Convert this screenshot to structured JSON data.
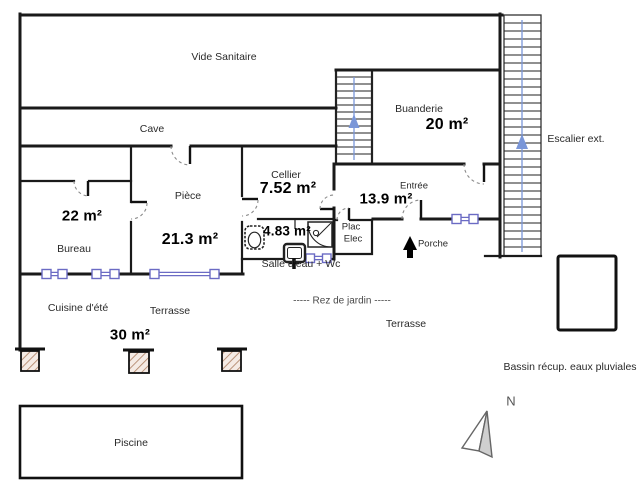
{
  "plan": {
    "rooms": {
      "vide_sanitaire": {
        "name": "Vide Sanitaire"
      },
      "cave": {
        "name": "Cave"
      },
      "buanderie": {
        "name": "Buanderie",
        "area": "20 m²"
      },
      "cellier": {
        "name": "Cellier",
        "area": "7.52 m²"
      },
      "piece": {
        "name": "Pièce",
        "area": "21.3 m²"
      },
      "bureau": {
        "name": "Bureau",
        "area": "22 m²"
      },
      "entree": {
        "name": "Entrée",
        "area": "13.9 m²"
      },
      "salle_eau": {
        "name": "Salle d'eau + Wc",
        "area": "4.83 m²"
      },
      "plac_elec": {
        "line1": "Plac",
        "line2": "Elec"
      },
      "cuisine_ete": {
        "name": "Cuisine d'été"
      },
      "terrasse_haut": {
        "name": "Terrasse",
        "area": "30 m²"
      },
      "terrasse_bas": {
        "name": "Terrasse"
      },
      "porche": {
        "name": "Porche"
      },
      "piscine": {
        "name": "Piscine"
      }
    },
    "annotations": {
      "escalier_ext": "Escalier ext.",
      "bassin": "Bassin récup. eaux pluviales",
      "rez_de_jardin": "-----   Rez de jardin   -----",
      "north": "N"
    },
    "colors": {
      "wall": "#1a1a1a",
      "window": "#6b6bc4",
      "stair": "#7a96d8",
      "door": "#8a8a8a",
      "hatchline": "#b08468",
      "hatchbg": "#f5ebe5"
    }
  }
}
